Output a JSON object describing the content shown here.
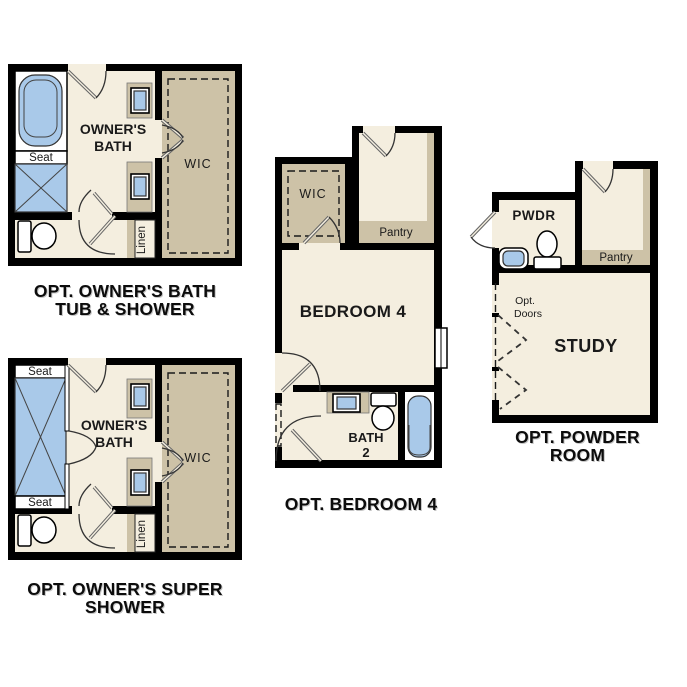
{
  "colors": {
    "wall": "#000000",
    "floor_cream": "#f4eedf",
    "cabinet_tan": "#cdc2a7",
    "fixture_blue": "#a9c9e9",
    "background": "#ffffff"
  },
  "plans": {
    "owners_bath": {
      "caption_line1": "OPT. OWNER'S BATH",
      "caption_line2": "TUB & SHOWER",
      "room_line1": "OWNER'S",
      "room_line2": "BATH",
      "seat": "Seat",
      "wic": "WIC",
      "linen": "Linen"
    },
    "super_shower": {
      "caption_line1": "OPT. OWNER'S SUPER",
      "caption_line2": "SHOWER",
      "room_line1": "OWNER'S",
      "room_line2": "BATH",
      "seat_top": "Seat",
      "seat_bottom": "Seat",
      "wic": "WIC",
      "linen": "Linen"
    },
    "bedroom4": {
      "caption": "OPT. BEDROOM 4",
      "room": "BEDROOM 4",
      "wic": "WIC",
      "pantry": "Pantry",
      "bath_line1": "BATH",
      "bath_line2": "2"
    },
    "powder_room": {
      "caption": "OPT. POWDER ROOM",
      "pwdr": "PWDR",
      "pantry": "Pantry",
      "study": "STUDY",
      "opt_doors_line1": "Opt.",
      "opt_doors_line2": "Doors"
    }
  }
}
